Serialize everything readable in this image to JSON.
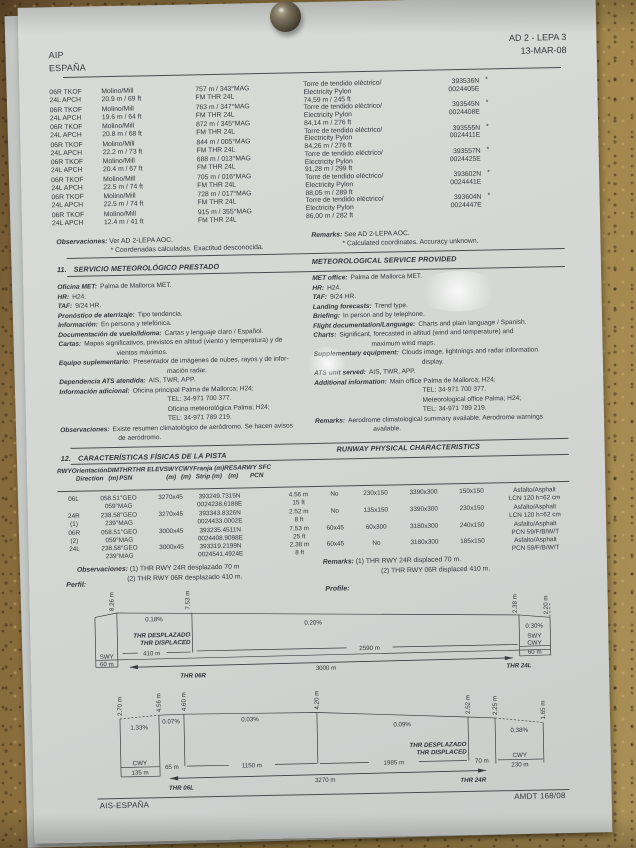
{
  "header": {
    "aip": "AIP",
    "country": "ESPAÑA",
    "ref": "AD 2 - LEPA 3",
    "date": "13-MAR-08"
  },
  "obstacles": {
    "left": [
      {
        "rwy_a": "06R TKOF",
        "rwy_b": "24L APCH",
        "ob_a": "Molino/Mill",
        "ob_b": "20.9 m / 69 ft",
        "ps_a": "757 m / 343°MAG",
        "ps_b": "FM THR 24L"
      },
      {
        "rwy_a": "06R TKOF",
        "rwy_b": "24L APCH",
        "ob_a": "Molino/Mill",
        "ob_b": "19.6 m / 64 ft",
        "ps_a": "763 m / 347°MAG",
        "ps_b": "FM THR 24L"
      },
      {
        "rwy_a": "06R TKOF",
        "rwy_b": "24L APCH",
        "ob_a": "Molino/Mill",
        "ob_b": "20.8 m / 68 ft",
        "ps_a": "872 m / 345°MAG",
        "ps_b": "FM THR 24L"
      },
      {
        "rwy_a": "06R TKOF",
        "rwy_b": "24L APCH",
        "ob_a": "Molino/Mill",
        "ob_b": "22.2 m / 73 ft",
        "ps_a": "844 m / 005°MAG",
        "ps_b": "FM THR 24L"
      },
      {
        "rwy_a": "06R TKOF",
        "rwy_b": "24L APCH",
        "ob_a": "Molino/Mill",
        "ob_b": "20.4 m / 67 ft",
        "ps_a": "688 m / 013°MAG",
        "ps_b": "FM THR 24L"
      },
      {
        "rwy_a": "06R TKOF",
        "rwy_b": "24L APCH",
        "ob_a": "Molino/Mill",
        "ob_b": "22.5 m / 74 ft",
        "ps_a": "705 m / 016°MAG",
        "ps_b": "FM THR 24L"
      },
      {
        "rwy_a": "06R TKOF",
        "rwy_b": "24L APCH",
        "ob_a": "Molino/Mill",
        "ob_b": "22.5 m / 74 ft",
        "ps_a": "728 m / 017°MAG",
        "ps_b": "FM THR 24L"
      },
      {
        "rwy_a": "06R TKOF",
        "rwy_b": "24L APCH",
        "ob_a": "Molino/Mill",
        "ob_b": "12.4 m / 41 ft",
        "ps_a": "915 m / 355°MAG",
        "ps_b": "FM THR 24L"
      }
    ],
    "right": [
      {
        "n_a": "Torre de tendido eléctrico/",
        "n_b": "Electricity Pylon",
        "h": "74,59 m / 245 ft",
        "c_a": "393536N",
        "c_b": "0024405E",
        "star": "*"
      },
      {
        "n_a": "Torre de tendido eléctrico/",
        "n_b": "Electricity Pylon",
        "h": "84,14 m / 276 ft",
        "c_a": "393545N",
        "c_b": "0024408E",
        "star": "*"
      },
      {
        "n_a": "Torre de tendido eléctrico/",
        "n_b": "Electricity Pylon",
        "h": "84,26 m / 276 ft",
        "c_a": "393555N",
        "c_b": "0024411E",
        "star": "*"
      },
      {
        "n_a": "Torre de tendido eléctrico/",
        "n_b": "Electricity Pylon",
        "h": "91,28 m / 299 ft",
        "c_a": "393557N",
        "c_b": "0024425E",
        "star": "*"
      },
      {
        "n_a": "Torre de tendido eléctrico/",
        "n_b": "Electricity Pylon",
        "h": "88,05 m / 289 ft",
        "c_a": "393602N",
        "c_b": "0024441E",
        "star": "*"
      },
      {
        "n_a": "Torre de tendido eléctrico/",
        "n_b": "Electricity Pylon",
        "h": "86,00 m / 282 ft",
        "c_a": "393604N",
        "c_b": "0024447E",
        "star": "*"
      }
    ],
    "obs_label": "Observaciones:",
    "obs_text": "Ver AD 2-LEPA AOC.",
    "obs_note": "* Coordenadas calculadas. Exactitud desconocida.",
    "rem_label": "Remarks:",
    "rem_text": "See AD 2-LEPA AOC.",
    "rem_note": "* Calculated coordinates. Accuracy unknown."
  },
  "met": {
    "num": "11.",
    "title_es": "SERVICIO METEOROLÓGICO PRESTADO",
    "title_en": "METEOROLOGICAL SERVICE PROVIDED",
    "left": [
      {
        "l": "Oficina MET:",
        "v": "Palma de Mallorca MET.",
        "i": 0
      },
      {
        "l": "HR:",
        "v": "H24.",
        "i": 0
      },
      {
        "l": "TAF:",
        "v": "9/24 HR.",
        "i": 0
      },
      {
        "l": "Pronóstico de aterrizaje:",
        "v": "Tipo tendencia.",
        "i": 0
      },
      {
        "l": "Información:",
        "v": "En persona y telefónica.",
        "i": 0
      },
      {
        "l": "Documentación de vuelo/Idioma:",
        "v": "Cartas y lenguaje claro / Español.",
        "i": 0
      },
      {
        "l": "Cartas:",
        "v": "Mapas significativos, previstos en altitud (viento y temperatura) y de",
        "i": 0
      },
      {
        "l": "",
        "v": "vientos máximos.",
        "i": 1
      },
      {
        "l": "Equipo suplementario:",
        "v": "Presentador de imágenes de nubes, rayos y de infor-",
        "i": 0
      },
      {
        "l": "",
        "v": "mación radar.",
        "i": 2
      },
      {
        "l": "Dependencia ATS atendida:",
        "v": "AIS, TWR, APP.",
        "i": 0
      },
      {
        "l": "Información adicional:",
        "v": "Oficina principal Palma de Mallorca; H24;",
        "i": 0
      },
      {
        "l": "",
        "v": "TEL: 34-971 700 377.",
        "i": 2
      },
      {
        "l": "",
        "v": "Oficina meteorológica Palma; H24;",
        "i": 2
      },
      {
        "l": "",
        "v": "TEL: 34-971 789 219.",
        "i": 2
      },
      {
        "l": "Observaciones:",
        "v": "Existe resumen climatológico de aeródromo. Se hacen avisos",
        "i": 0
      },
      {
        "l": "",
        "v": "de aeródromo.",
        "i": 1
      }
    ],
    "right": [
      {
        "l": "MET office:",
        "v": "Palma de Mallorca MET.",
        "i": 0
      },
      {
        "l": "HR:",
        "v": "H24.",
        "i": 0
      },
      {
        "l": "TAF:",
        "v": "9/24 HR.",
        "i": 0
      },
      {
        "l": "Landing forecasts:",
        "v": "Trend type.",
        "i": 0
      },
      {
        "l": "Briefing:",
        "v": "In person and by telephone.",
        "i": 0
      },
      {
        "l": "Flight documentation/Language:",
        "v": "Charts and plain language / Spanish.",
        "i": 0
      },
      {
        "l": "Charts:",
        "v": "Significant, forecasted in altitud (wind and temperature) and",
        "i": 0
      },
      {
        "l": "",
        "v": "maximum wind maps.",
        "i": 1
      },
      {
        "l": "Supplementary equipment:",
        "v": "Clouds image, lightnings and radar information",
        "i": 0
      },
      {
        "l": "",
        "v": "display.",
        "i": 2
      },
      {
        "l": "ATS unit served:",
        "v": "AIS, TWR, APP.",
        "i": 0
      },
      {
        "l": "Additional information:",
        "v": "Main office Palma de Mallorca; H24;",
        "i": 0
      },
      {
        "l": "",
        "v": "TEL: 34-971 700 377.",
        "i": 2
      },
      {
        "l": "",
        "v": "Meteorological office Palma; H24;",
        "i": 2
      },
      {
        "l": "",
        "v": "TEL: 34-971 789 219.",
        "i": 2
      },
      {
        "l": "Remarks:",
        "v": "Aerodrome climatological summary available. Aerodrome warnings",
        "i": 0
      },
      {
        "l": "",
        "v": "available.",
        "i": 1
      }
    ]
  },
  "runway": {
    "num": "12.",
    "title_es": "CARACTERÍSTICAS FÍSICAS DE LA PISTA",
    "title_en": "RUNWAY PHYSICAL CHARACTERISTICS",
    "headers": [
      {
        "a": "RWY",
        "b": ""
      },
      {
        "a": "Orientación",
        "b": "Direction"
      },
      {
        "a": "DIM",
        "b": "(m)"
      },
      {
        "a": "THR",
        "b": "PSN"
      },
      {
        "a": "THR  ELEV",
        "b": ""
      },
      {
        "a": "SWY",
        "b": "(m)"
      },
      {
        "a": "CWY",
        "b": "(m)"
      },
      {
        "a": "Franja (m)",
        "b": "Strip (m)"
      },
      {
        "a": "RESA",
        "b": "(m)"
      },
      {
        "a": "RWY SFC",
        "b": "PCN"
      }
    ],
    "rows": [
      {
        "rwy_a": "06L",
        "rwy_b": "",
        "dir_a": "058.51°GEO",
        "dir_b": "059°MAG",
        "dim": "3270x45",
        "psn_a": "393249.7315N",
        "psn_b": "0024238.6188E",
        "el_a": "4.56 m",
        "el_b": "15 ft",
        "swy": "No",
        "cwy": "230x150",
        "strip": "3390x300",
        "resa": "150x150",
        "sfc_a": "Asfalto/Asphalt",
        "sfc_b": "LCN 120 h=62 cm"
      },
      {
        "rwy_a": "24R",
        "rwy_b": "(1)",
        "dir_a": "238.58°GEO",
        "dir_b": "239°MAG",
        "dim": "3270x45",
        "psn_a": "393343.8326N",
        "psn_b": "0024433.0002E",
        "el_a": "2.52 m",
        "el_b": "8 ft",
        "swy": "No",
        "cwy": "135x150",
        "strip": "3390x300",
        "resa": "230x150",
        "sfc_a": "Asfalto/Asphalt",
        "sfc_b": "LCN 120 h=62 cm"
      },
      {
        "rwy_a": "06R",
        "rwy_b": "(2)",
        "dir_a": "058.51°GEO",
        "dir_b": "059°MAG",
        "dim": "3000x45",
        "psn_a": "393235.4511N",
        "psn_b": "0024408.9098E",
        "el_a": "7.53 m",
        "el_b": "25 ft",
        "swy": "60x45",
        "cwy": "60x300",
        "strip": "3180x300",
        "resa": "240x150",
        "sfc_a": "Asfalto/Asphalt",
        "sfc_b": "PCN 59/F/B/W/T"
      },
      {
        "rwy_a": "24L",
        "rwy_b": "",
        "dir_a": "238.58°GEO",
        "dir_b": "239°MAG",
        "dim": "3000x45",
        "psn_a": "393319.2199N",
        "psn_b": "0024541.4924E",
        "el_a": "2.38 m",
        "el_b": "8 ft",
        "swy": "60x45",
        "cwy": "No",
        "strip": "3180x300",
        "resa": "185x150",
        "sfc_a": "Asfalto/Asphalt",
        "sfc_b": "PCN 59/F/B/W/T"
      }
    ],
    "obs_label": "Observaciones:",
    "obs_1": "(1) THR RWY 24R desplazado 70 m",
    "obs_2": "(2) THR RWY 06R desplazado 410 m.",
    "rem_label": "Remarks:",
    "rem_1": "(1) THR RWY 24R displaced 70 m.",
    "rem_2": "(2) THR RWY 06R displaced 410 m.",
    "profile_es": "Perfil:",
    "profile_en": "Profile:"
  },
  "profile1": {
    "h1": "8.26 m",
    "h2": "7.53 m",
    "h3": "2.38 m",
    "h4": "2.20 m",
    "s1": "0.18%",
    "s2": "0.20%",
    "s3": "0.30%",
    "disp1": "THR DESPLAZADO",
    "disp2": "THR DISPLACED",
    "swy": "SWY",
    "cwy": "CWY",
    "m60": "60 m",
    "seg1": "410 m",
    "seg2": "2590 m",
    "total": "3000 m",
    "thr_l": "THR 06R",
    "thr_r": "THR 24L"
  },
  "profile2": {
    "h1": "2.70 m",
    "h2": "4.56 m",
    "h3": "4.60 m",
    "h4": "4.20 m",
    "h5": "2.52 m",
    "h6": "2.25 m",
    "h7": "1.65 m",
    "s1": "1.33%",
    "s2": "0.07%",
    "s3": "0.03%",
    "s4": "0.09%",
    "s5": "0.38%",
    "cwy": "CWY",
    "m135": "135 m",
    "m65": "65 m",
    "m1150": "1150 m",
    "m1985": "1985 m",
    "m70": "70 m",
    "m230": "230 m",
    "disp1": "THR DESPLAZADO",
    "disp2": "THR DISPLACED",
    "total": "3270 m",
    "thr_l": "THR 06L",
    "thr_r": "THR 24R"
  },
  "footer": {
    "left": "AIS-ESPAÑA",
    "right": "AMDT 168/08"
  }
}
